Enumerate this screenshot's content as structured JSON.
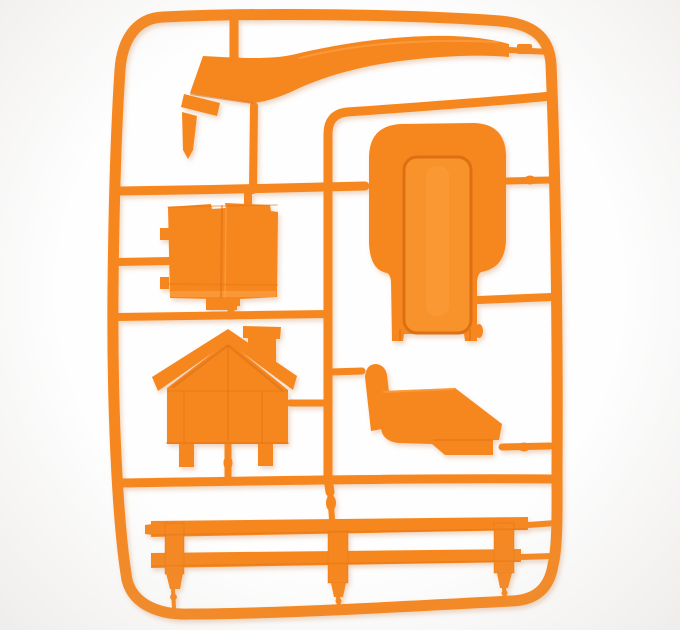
{
  "scene": {
    "type": "photograph",
    "description": "Bright orange injection-molded plastic model sprue (parts tree) for a toy house playset, lying on a plain white background",
    "material": "glossy orange plastic",
    "background_label": "white seamless backdrop"
  },
  "colors": {
    "plastic": "#f6871f",
    "plasticMid": "#f8922a",
    "plasticDark": "#de6f12",
    "plasticDeep": "#c25c0b",
    "plasticLight": "#ffab52",
    "bg": "#fefefe",
    "vignette": "rgba(186,178,170,0.22)",
    "shadow": "rgba(201,121,58,0.30)"
  },
  "frame": {
    "label": "Rounded rectangular sprue runner frame with internal runners and sprue gates"
  },
  "parts": [
    {
      "id": "curved-roof-strip",
      "label": "Long curved roof/ridge strip with angled flared left end"
    },
    {
      "id": "wall-panel",
      "label": "Folded square wall panel with side tabs"
    },
    {
      "id": "slide-panel",
      "label": "Large rounded panel with recessed channel and lower column"
    },
    {
      "id": "gable-house",
      "label": "House gable end with overhanging roof and chimney"
    },
    {
      "id": "bench-seat",
      "label": "Bench seat side profile with back post and footrest"
    },
    {
      "id": "fence",
      "label": "Two-rail fence with three pointed posts"
    }
  ]
}
